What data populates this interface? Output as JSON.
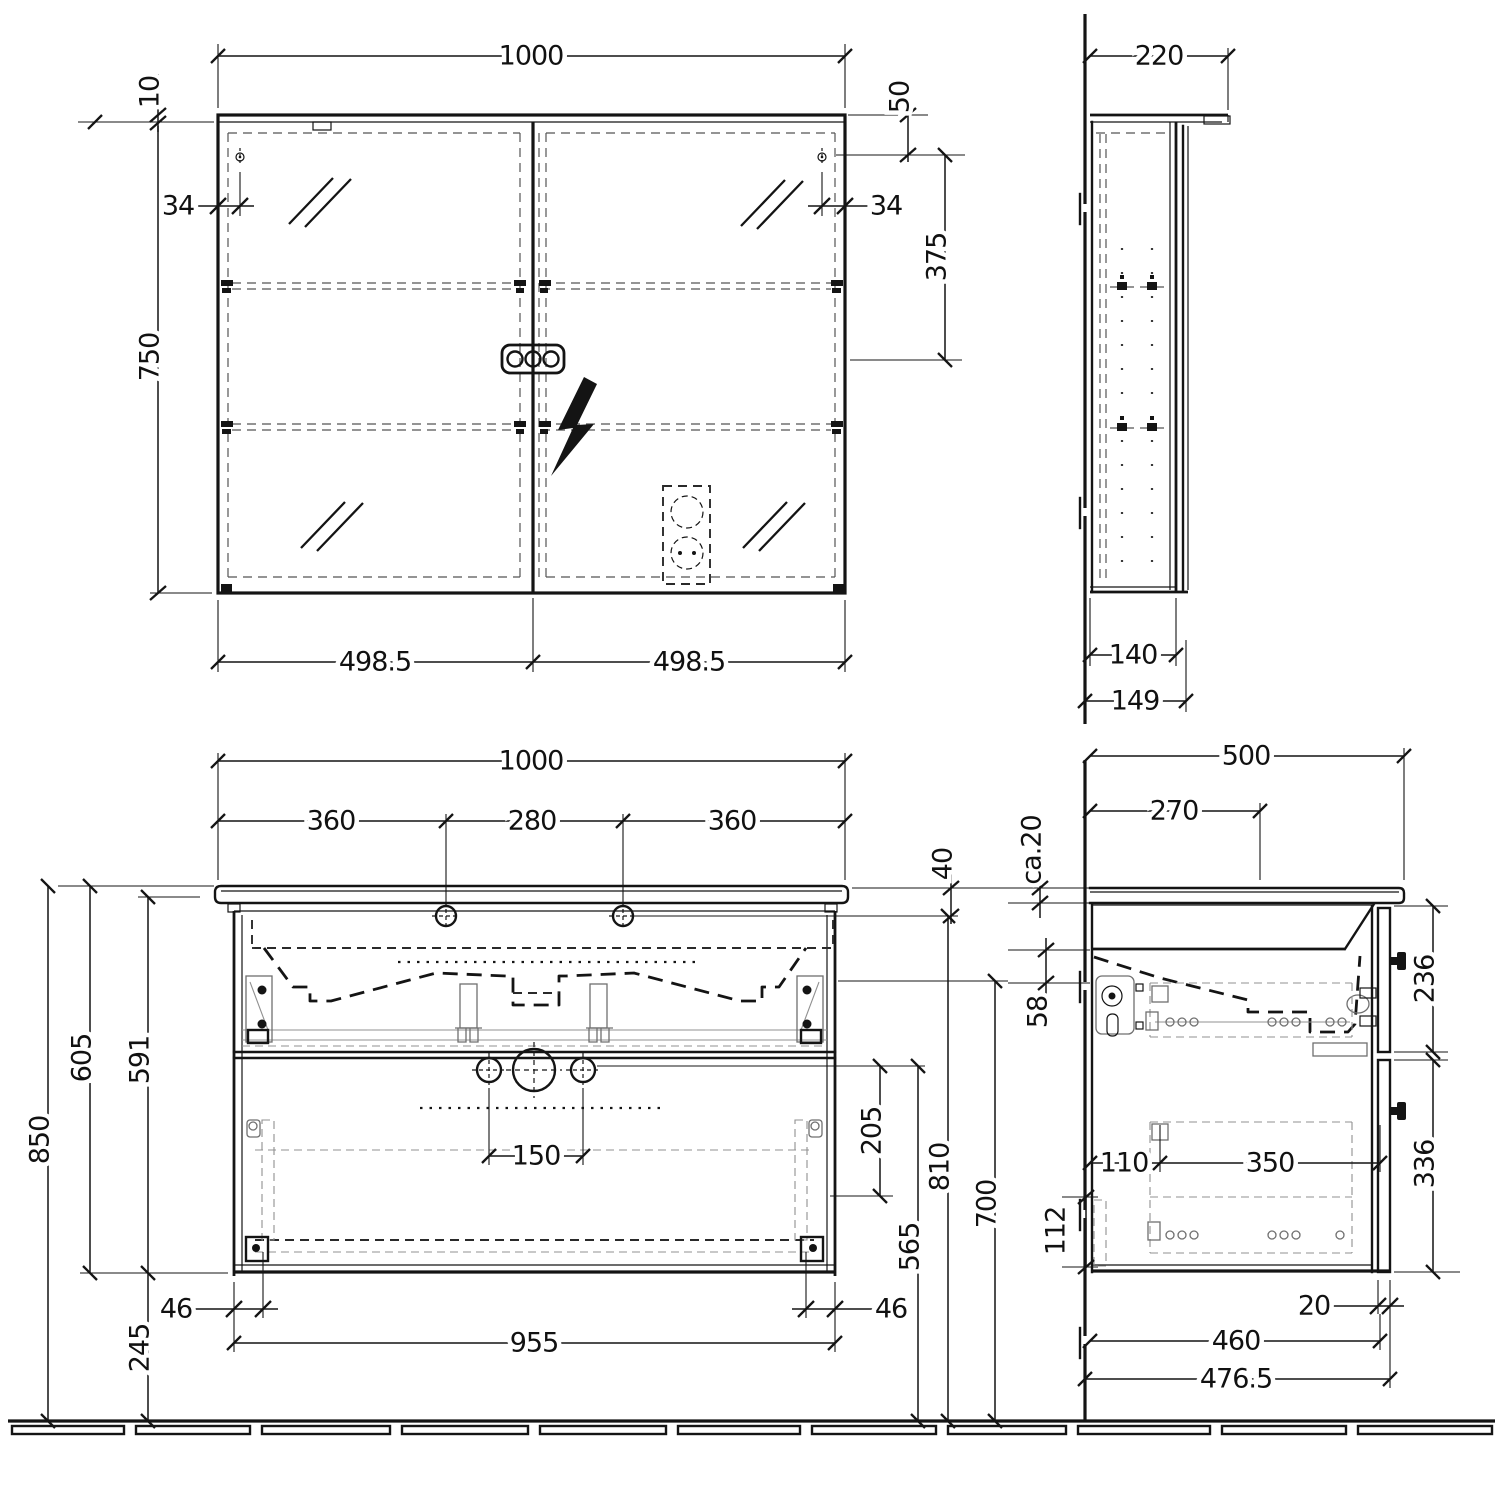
{
  "drawing": {
    "type": "furniture installation drawing",
    "colors": {
      "line": "#141414",
      "hardware_light": "#909090",
      "hidden_dash": "#555555",
      "background": "#ffffff"
    }
  },
  "dims": {
    "mirror_front": {
      "width": "1000",
      "top_offset": "10",
      "height": "750",
      "hinge_left": "34",
      "hinge_right": "34",
      "top_to_hinge": "50",
      "hinge_to_center": "375",
      "door_left": "498.5",
      "door_right": "498.5"
    },
    "mirror_side": {
      "depth": "220",
      "body_depth": "140",
      "total_depth": "149"
    },
    "vanity_front": {
      "width": "1000",
      "tap_left": "360",
      "tap_center": "280",
      "tap_right": "360",
      "top_thickness": "40",
      "height_total": "850",
      "height_cabinet": "605",
      "height_carcass": "591",
      "floor_clearance": "245",
      "slide_inset_left": "46",
      "slide_inset_right": "46",
      "carcass_width": "955",
      "drain_spacing": "150",
      "drain_offset": "205",
      "divider_height": "565",
      "underside_height": "810",
      "drain_height": "700"
    },
    "vanity_side": {
      "depth": "500",
      "tap_depth": "270",
      "top_thickness": "ca.20",
      "apron": "58",
      "drawer_upper": "236",
      "drawer_lower": "336",
      "slide_back": "110",
      "slide_length": "350",
      "slide_bottom": "112",
      "front_overhang": "20",
      "carcass_depth": "460",
      "total_depth": "476.5"
    }
  }
}
